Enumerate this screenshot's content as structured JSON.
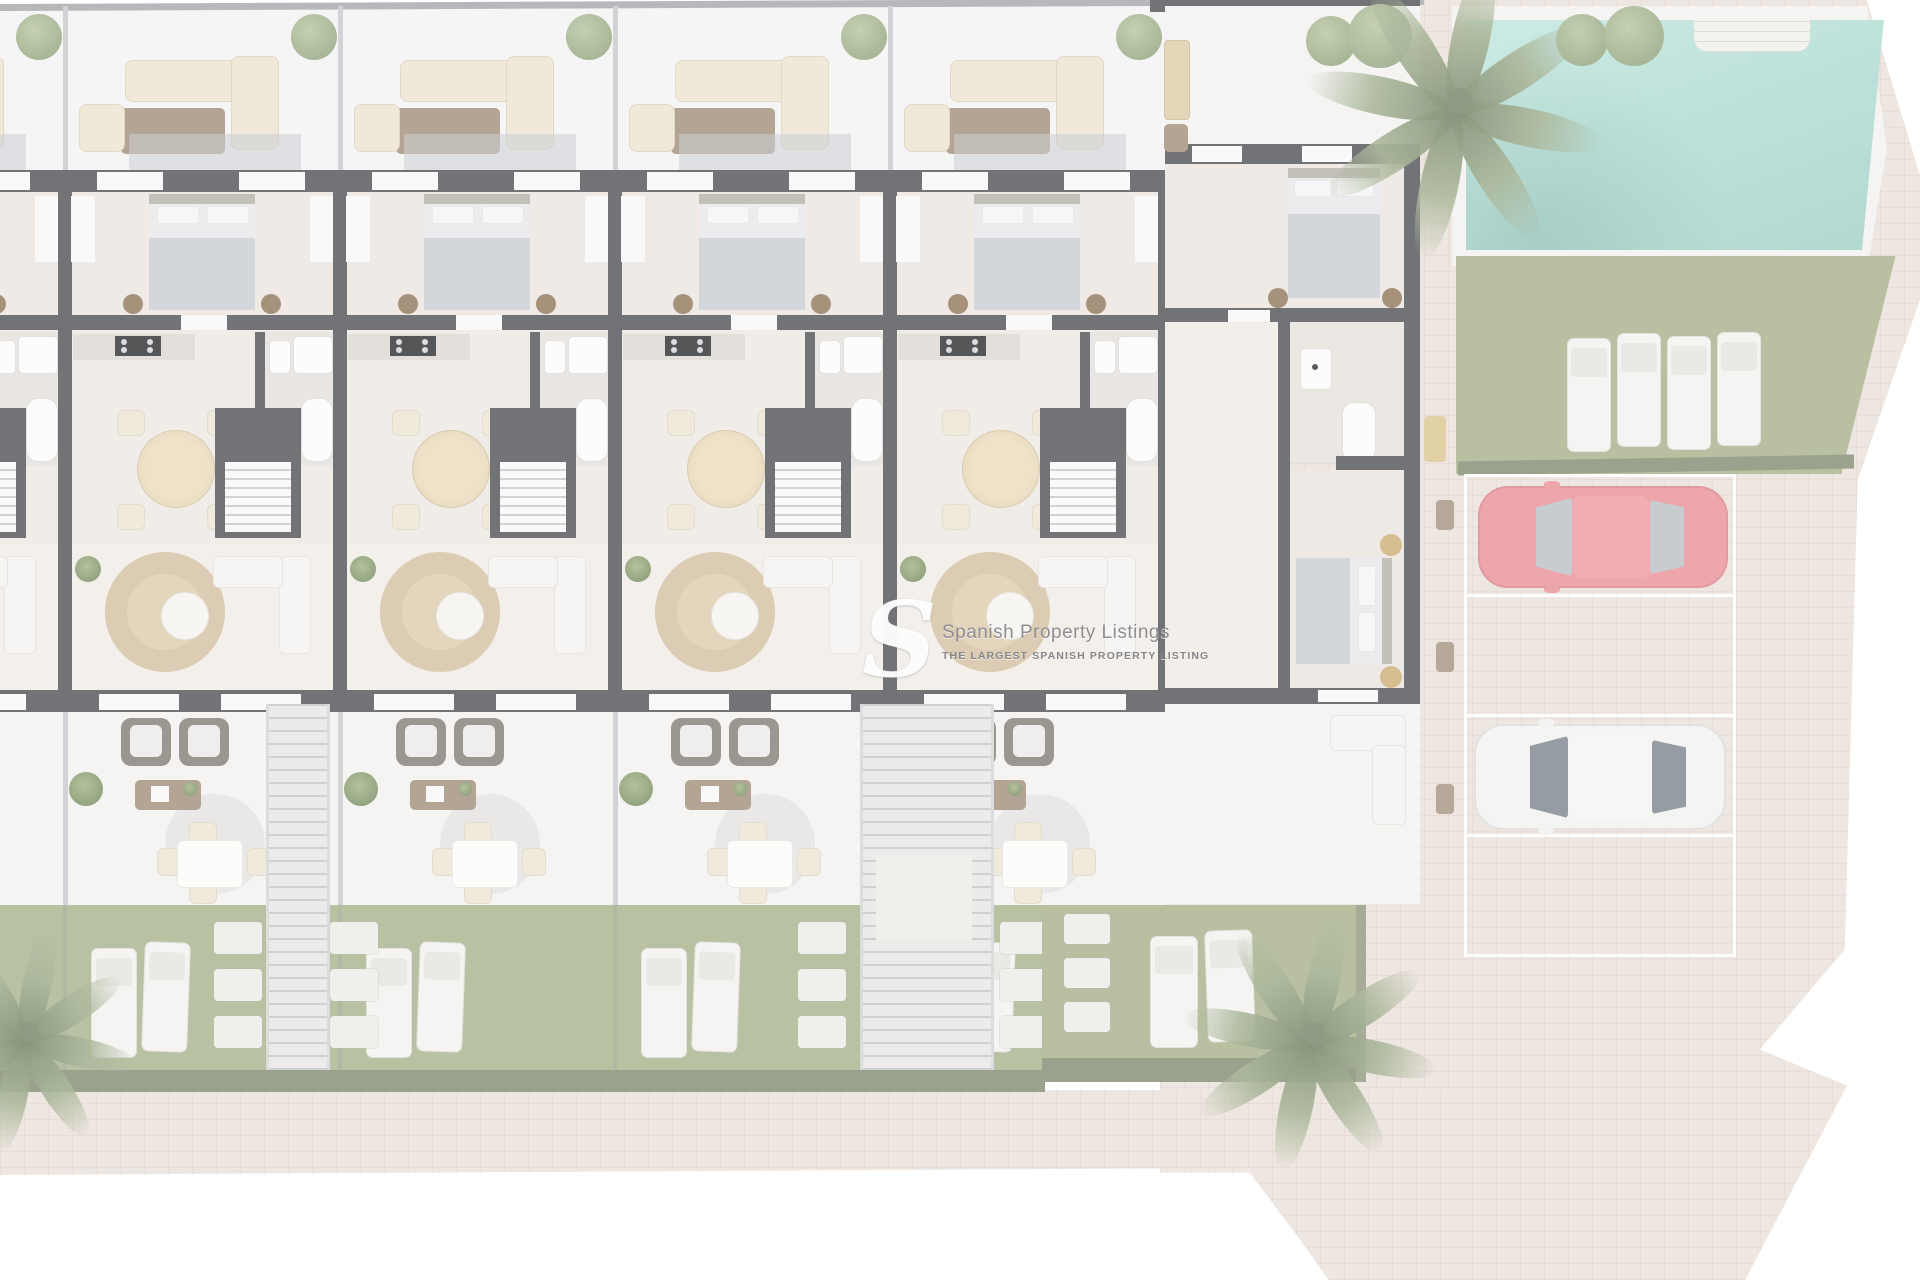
{
  "scene": {
    "description": "Top-down 3D architectural site plan render of a row of apartments with roof terraces, gardens, a communal swimming pool and a parking area",
    "style": "washed-out render with white overlay and watermark"
  },
  "watermark": {
    "logo": "S",
    "title": "Spanish Property Listings",
    "subtitle": "THE LARGEST SPANISH PROPERTY LISTING"
  },
  "building": {
    "units": [
      {
        "id": "unit-0",
        "partial": true,
        "rooms": [
          "roof-terrace",
          "bedroom",
          "kitchen",
          "bathroom",
          "living-dining",
          "terrace",
          "garden"
        ]
      },
      {
        "id": "unit-1",
        "partial": false,
        "rooms": [
          "roof-terrace",
          "bedroom",
          "kitchen",
          "bathroom",
          "living-dining",
          "terrace",
          "garden"
        ]
      },
      {
        "id": "unit-2",
        "partial": false,
        "rooms": [
          "roof-terrace",
          "bedroom",
          "kitchen",
          "bathroom",
          "living-dining",
          "terrace",
          "garden"
        ]
      },
      {
        "id": "unit-3",
        "partial": false,
        "rooms": [
          "roof-terrace",
          "bedroom",
          "kitchen",
          "bathroom",
          "living-dining",
          "terrace",
          "garden"
        ]
      },
      {
        "id": "unit-4",
        "partial": false,
        "rooms": [
          "roof-terrace",
          "bedroom",
          "kitchen",
          "bathroom",
          "living-dining",
          "terrace",
          "garden"
        ]
      }
    ],
    "right_wing": {
      "rooms": [
        "terrace",
        "bedroom",
        "bathroom",
        "bedroom"
      ],
      "gold_poufs": 2
    },
    "outdoor_stairs": 2
  },
  "amenities": {
    "pool": {
      "shape": "rectangular",
      "water_color": "#a5d6cc",
      "steps": true
    },
    "pool_lawn_loungers": 4,
    "garden_loungers_per_unit": 2,
    "palm_trees": 3,
    "round_bushes": 4,
    "bench_by_pool": 1
  },
  "parking": {
    "slots": 4,
    "empty_slots": 2,
    "cars": [
      {
        "color_name": "red",
        "body_color": "#e78b93",
        "glass_color": "#b6bcc3",
        "slot_index": 0
      },
      {
        "color_name": "white",
        "body_color": "#f1f1ef",
        "glass_color": "#767d87",
        "slot_index": 2
      }
    ]
  },
  "palette": {
    "pavement": "#e9ded7",
    "wall_dark": "#46474b",
    "grass": "#a4ae86",
    "hedge": "#7b8468",
    "bedroom_floor": "#eae4de",
    "terrace_floor": "#f2f1ee",
    "jute_rug": "#d1bd9b",
    "wood": "#9c8872",
    "pool_water": "#a5d6cc"
  }
}
